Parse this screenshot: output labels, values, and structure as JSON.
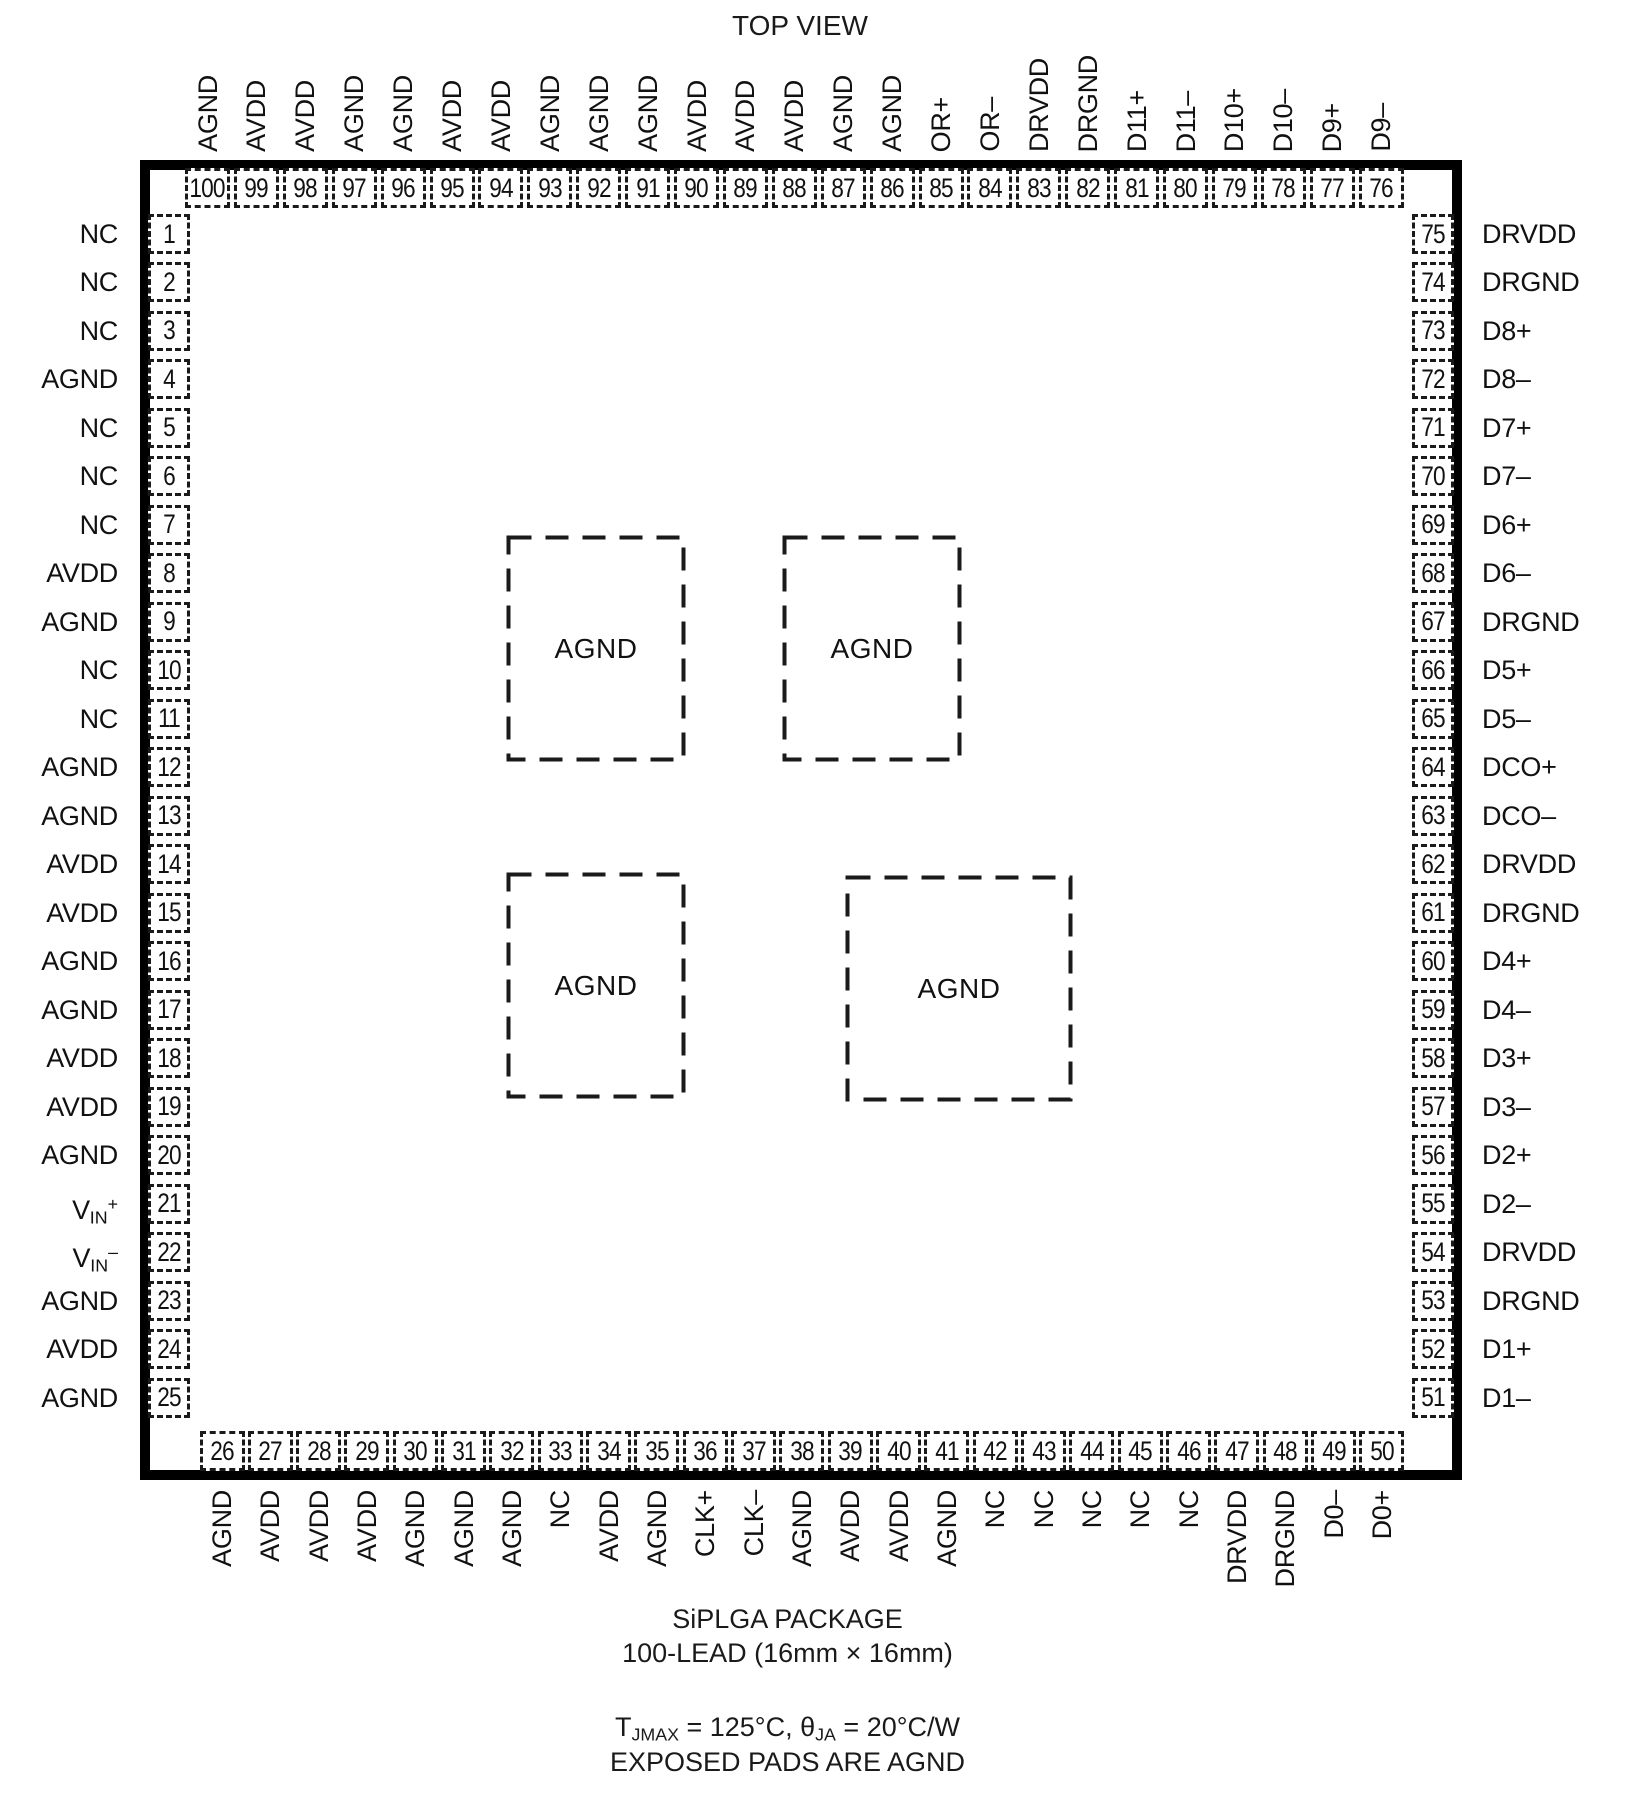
{
  "title": "TOP VIEW",
  "package": {
    "top_pins": [
      {
        "num": "100",
        "label": "AGND"
      },
      {
        "num": "99",
        "label": "AVDD"
      },
      {
        "num": "98",
        "label": "AVDD"
      },
      {
        "num": "97",
        "label": "AGND"
      },
      {
        "num": "96",
        "label": "AGND"
      },
      {
        "num": "95",
        "label": "AVDD"
      },
      {
        "num": "94",
        "label": "AVDD"
      },
      {
        "num": "93",
        "label": "AGND"
      },
      {
        "num": "92",
        "label": "AGND"
      },
      {
        "num": "91",
        "label": "AGND"
      },
      {
        "num": "90",
        "label": "AVDD"
      },
      {
        "num": "89",
        "label": "AVDD"
      },
      {
        "num": "88",
        "label": "AVDD"
      },
      {
        "num": "87",
        "label": "AGND"
      },
      {
        "num": "86",
        "label": "AGND"
      },
      {
        "num": "85",
        "label": "OR+"
      },
      {
        "num": "84",
        "label": "OR–"
      },
      {
        "num": "83",
        "label": "DRVDD"
      },
      {
        "num": "82",
        "label": "DRGND"
      },
      {
        "num": "81",
        "label": "D11+"
      },
      {
        "num": "80",
        "label": "D11–"
      },
      {
        "num": "79",
        "label": "D10+"
      },
      {
        "num": "78",
        "label": "D10–"
      },
      {
        "num": "77",
        "label": "D9+"
      },
      {
        "num": "76",
        "label": "D9–"
      }
    ],
    "left_pins": [
      {
        "num": "1",
        "label": "NC"
      },
      {
        "num": "2",
        "label": "NC"
      },
      {
        "num": "3",
        "label": "NC"
      },
      {
        "num": "4",
        "label": "AGND"
      },
      {
        "num": "5",
        "label": "NC"
      },
      {
        "num": "6",
        "label": "NC"
      },
      {
        "num": "7",
        "label": "NC"
      },
      {
        "num": "8",
        "label": "AVDD"
      },
      {
        "num": "9",
        "label": "AGND"
      },
      {
        "num": "10",
        "label": "NC"
      },
      {
        "num": "11",
        "label": "NC"
      },
      {
        "num": "12",
        "label": "AGND"
      },
      {
        "num": "13",
        "label": "AGND"
      },
      {
        "num": "14",
        "label": "AVDD"
      },
      {
        "num": "15",
        "label": "AVDD"
      },
      {
        "num": "16",
        "label": "AGND"
      },
      {
        "num": "17",
        "label": "AGND"
      },
      {
        "num": "18",
        "label": "AVDD"
      },
      {
        "num": "19",
        "label": "AVDD"
      },
      {
        "num": "20",
        "label": "AGND"
      },
      {
        "num": "21",
        "label": "VIN+",
        "parts": {
          "base": "V",
          "sub": "IN",
          "sup": "+"
        }
      },
      {
        "num": "22",
        "label": "VIN–",
        "parts": {
          "base": "V",
          "sub": "IN",
          "sup": "–"
        }
      },
      {
        "num": "23",
        "label": "AGND"
      },
      {
        "num": "24",
        "label": "AVDD"
      },
      {
        "num": "25",
        "label": "AGND"
      }
    ],
    "right_pins": [
      {
        "num": "75",
        "label": "DRVDD"
      },
      {
        "num": "74",
        "label": "DRGND"
      },
      {
        "num": "73",
        "label": "D8+"
      },
      {
        "num": "72",
        "label": "D8–"
      },
      {
        "num": "71",
        "label": "D7+"
      },
      {
        "num": "70",
        "label": "D7–"
      },
      {
        "num": "69",
        "label": "D6+"
      },
      {
        "num": "68",
        "label": "D6–"
      },
      {
        "num": "67",
        "label": "DRGND"
      },
      {
        "num": "66",
        "label": "D5+"
      },
      {
        "num": "65",
        "label": "D5–"
      },
      {
        "num": "64",
        "label": "DCO+"
      },
      {
        "num": "63",
        "label": "DCO–"
      },
      {
        "num": "62",
        "label": "DRVDD"
      },
      {
        "num": "61",
        "label": "DRGND"
      },
      {
        "num": "60",
        "label": "D4+"
      },
      {
        "num": "59",
        "label": "D4–"
      },
      {
        "num": "58",
        "label": "D3+"
      },
      {
        "num": "57",
        "label": "D3–"
      },
      {
        "num": "56",
        "label": "D2+"
      },
      {
        "num": "55",
        "label": "D2–"
      },
      {
        "num": "54",
        "label": "DRVDD"
      },
      {
        "num": "53",
        "label": "DRGND"
      },
      {
        "num": "52",
        "label": "D1+"
      },
      {
        "num": "51",
        "label": "D1–"
      }
    ],
    "bottom_pins": [
      {
        "num": "26",
        "label": "AGND"
      },
      {
        "num": "27",
        "label": "AVDD"
      },
      {
        "num": "28",
        "label": "AVDD"
      },
      {
        "num": "29",
        "label": "AVDD"
      },
      {
        "num": "30",
        "label": "AGND"
      },
      {
        "num": "31",
        "label": "AGND"
      },
      {
        "num": "32",
        "label": "AGND"
      },
      {
        "num": "33",
        "label": "NC"
      },
      {
        "num": "34",
        "label": "AVDD"
      },
      {
        "num": "35",
        "label": "AGND"
      },
      {
        "num": "36",
        "label": "CLK+"
      },
      {
        "num": "37",
        "label": "CLK–"
      },
      {
        "num": "38",
        "label": "AGND"
      },
      {
        "num": "39",
        "label": "AVDD"
      },
      {
        "num": "40",
        "label": "AVDD"
      },
      {
        "num": "41",
        "label": "AGND"
      },
      {
        "num": "42",
        "label": "NC"
      },
      {
        "num": "43",
        "label": "NC"
      },
      {
        "num": "44",
        "label": "NC"
      },
      {
        "num": "45",
        "label": "NC"
      },
      {
        "num": "46",
        "label": "NC"
      },
      {
        "num": "47",
        "label": "DRVDD"
      },
      {
        "num": "48",
        "label": "DRGND"
      },
      {
        "num": "49",
        "label": "D0–"
      },
      {
        "num": "50",
        "label": "D0+"
      }
    ],
    "exposed_pads": [
      {
        "label": "AGND"
      },
      {
        "label": "AGND"
      },
      {
        "label": "AGND"
      },
      {
        "label": "AGND"
      }
    ]
  },
  "footer": {
    "package_name": "SiPLGA PACKAGE",
    "lead_count": "100-LEAD (16mm × 16mm)",
    "thermal_segments": [
      {
        "text": "T"
      },
      {
        "sub": "JMAX"
      },
      {
        "text": " = 125°C, θ"
      },
      {
        "sub": "JA"
      },
      {
        "text": " = 20°C/W"
      }
    ],
    "exposed_note": "EXPOSED PADS ARE AGND"
  }
}
